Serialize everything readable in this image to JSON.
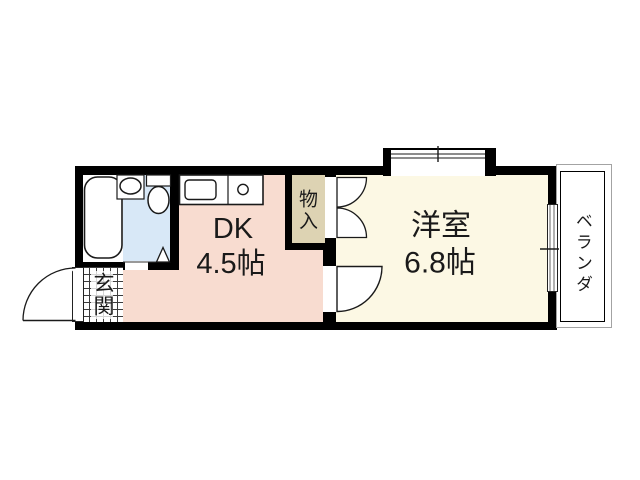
{
  "floorplan": {
    "title": "1DK apartment floor plan",
    "rooms": {
      "dk": {
        "name": "DK",
        "area": "4.5帖"
      },
      "western_room": {
        "name": "洋室",
        "area": "6.8帖"
      },
      "storage": {
        "name": "物入"
      },
      "entrance": {
        "name": "玄関"
      },
      "veranda": {
        "name": "ベランダ"
      }
    },
    "fixtures": [
      "bathtub",
      "washbasin",
      "toilet",
      "kitchen-counter",
      "kitchen-sink",
      "stove-burner"
    ],
    "features": [
      "entrance-door-swing",
      "room-door-swing",
      "storage-double-doors",
      "bay-window",
      "sliding-window-to-veranda",
      "bathroom-folding-door"
    ],
    "colors": {
      "wall": "#000000",
      "dk_floor": "#f8dcd0",
      "western_floor": "#fcf8e4",
      "storage_floor": "#ddd3b3",
      "bathroom_floor": "#d8e8f7",
      "background": "#ffffff"
    }
  }
}
